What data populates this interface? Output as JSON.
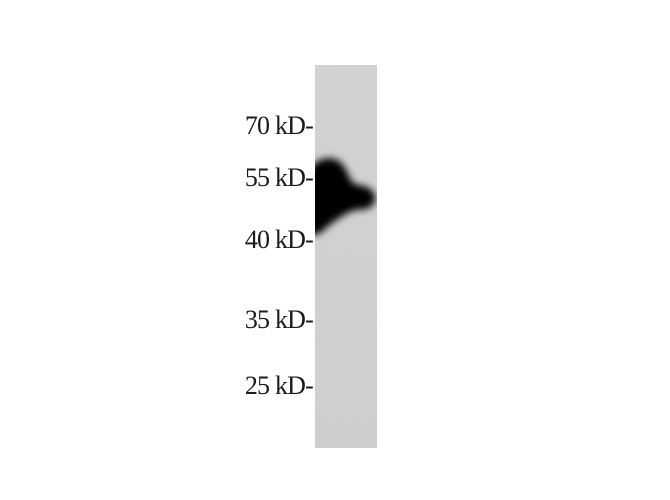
{
  "figure": {
    "kind": "western-blot",
    "lane_count": 1,
    "markers": [
      {
        "label": "70 kD-",
        "value_kd": 70
      },
      {
        "label": "55 kD-",
        "value_kd": 55
      },
      {
        "label": "40 kD-",
        "value_kd": 40
      },
      {
        "label": "35 kD-",
        "value_kd": 35
      },
      {
        "label": "25 kD-",
        "value_kd": 25
      }
    ],
    "bands": [
      {
        "description": "single strong dark band spanning between the 55 kD and 40 kD markers, bulging toward the right side of the lane",
        "approx_kd_range": "≈42-55 kD"
      }
    ],
    "colors": {
      "background": "#ffffff",
      "lane_top": "#d3d3d3",
      "lane_bottom": "#cfcfcf",
      "band": "#010101",
      "label_text": "#1b1b1b"
    }
  }
}
